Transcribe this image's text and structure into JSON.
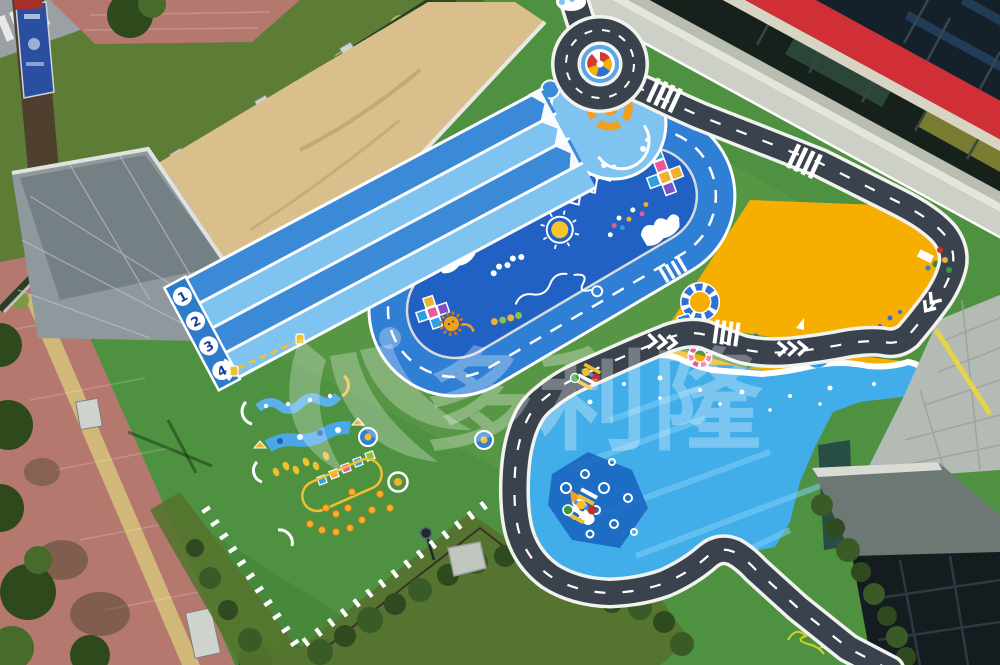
{
  "watermark": {
    "text": "多利隆"
  },
  "lanes": {
    "numbers": [
      "1",
      "2",
      "3",
      "4"
    ]
  },
  "icons": {
    "swoosh": "logo-swoosh",
    "roundabout_center": "pinwheel",
    "rocket": "rocket",
    "sun": "sun",
    "lion": "lion",
    "swim_ring": "swim-ring",
    "umbrella": "beach-umbrella",
    "lamp": "lamp-post"
  },
  "colors": {
    "turf": "#4e9140",
    "turfDark": "#44853a",
    "lawn": "#5d7c36",
    "treeDark": "#2e4a1c",
    "treeLight": "#476b2b",
    "bushLight": "#a9b94d",
    "bushMid": "#7a9b3f",
    "sand": "#d9bf8c",
    "plazaGrey": "#8f999d",
    "brickRed": "#b5786e",
    "brickYellow": "#d2b878",
    "streetGrey": "#9aa0a3",
    "fenceDark": "#2a3e25",
    "pillarGrey": "#cfd3cd",
    "laneLight": "#7fc3f0",
    "laneMid": "#3a8ad8",
    "laneCap": "#2e7cc9",
    "numberNavy": "#1a3f94",
    "trackBlue": "#2f7fd5",
    "fieldBlue": "#2161c3",
    "roadDark": "#3a434d",
    "roadWhite": "#f2f2ef",
    "orange": "#f6ae00",
    "sea": "#41aeea",
    "seaLight": "#7fcdf6",
    "seaDeep": "#1b66c0",
    "buildingRed": "#d02f38",
    "glassDark": "#17211c",
    "glassTop": "#14202a",
    "glassBlue": "#2b4f74",
    "walkway": "#ccd0c6",
    "stepLight": "#e4e6de",
    "stepMid": "#b9bdb2",
    "cream": "#d8d4c4",
    "stone": "#b4bab4",
    "hedge": "#3a5a26",
    "naturalGrass": "#55742f",
    "yellowMark": "#f0c030",
    "sunYellow": "#f7c52a",
    "canopyGrey": "#6d7874",
    "glassCorner": "#151c20"
  }
}
